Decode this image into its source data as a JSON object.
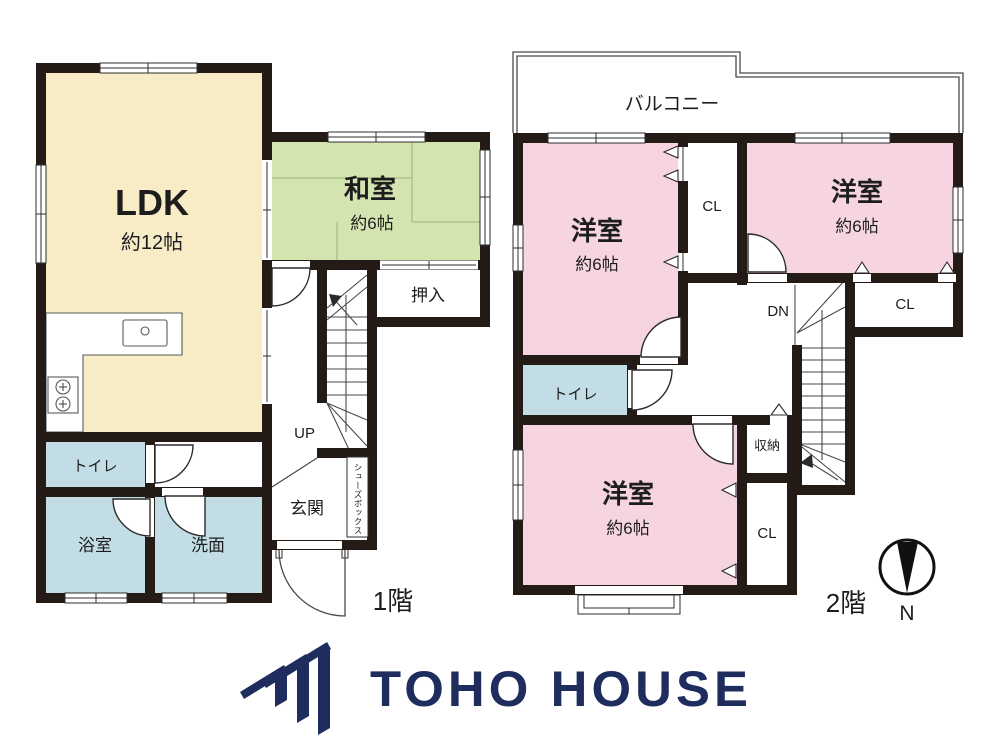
{
  "colors": {
    "wall": "#241b17",
    "navy": "#1e2c5e",
    "ldk_floor": "#f8ecc6",
    "tatami_floor": "#d4e4b1",
    "western_floor": "#f6d4e2",
    "wet_floor": "#c3dde7"
  },
  "floor1": {
    "label": "1階",
    "ldk": {
      "name": "LDK",
      "size": "約12帖"
    },
    "washitsu": {
      "name": "和室",
      "size": "約6帖"
    },
    "oshiire": "押入",
    "toilet": "トイレ",
    "bath": "浴室",
    "washroom": "洗面",
    "entrance": "玄関",
    "shoebox": "シューズボックス",
    "stair": "UP"
  },
  "floor2": {
    "label": "2階",
    "balcony": "バルコニー",
    "bed_left": {
      "name": "洋室",
      "size": "約6帖"
    },
    "bed_right": {
      "name": "洋室",
      "size": "約6帖"
    },
    "bed_bottom": {
      "name": "洋室",
      "size": "約6帖"
    },
    "cl_top": "CL",
    "cl_right": "CL",
    "cl_bottom": "CL",
    "toilet": "トイレ",
    "storage": "収納",
    "stair": "DN"
  },
  "compass": {
    "north_label": "N"
  },
  "logo": {
    "brand": "TOHO HOUSE"
  }
}
